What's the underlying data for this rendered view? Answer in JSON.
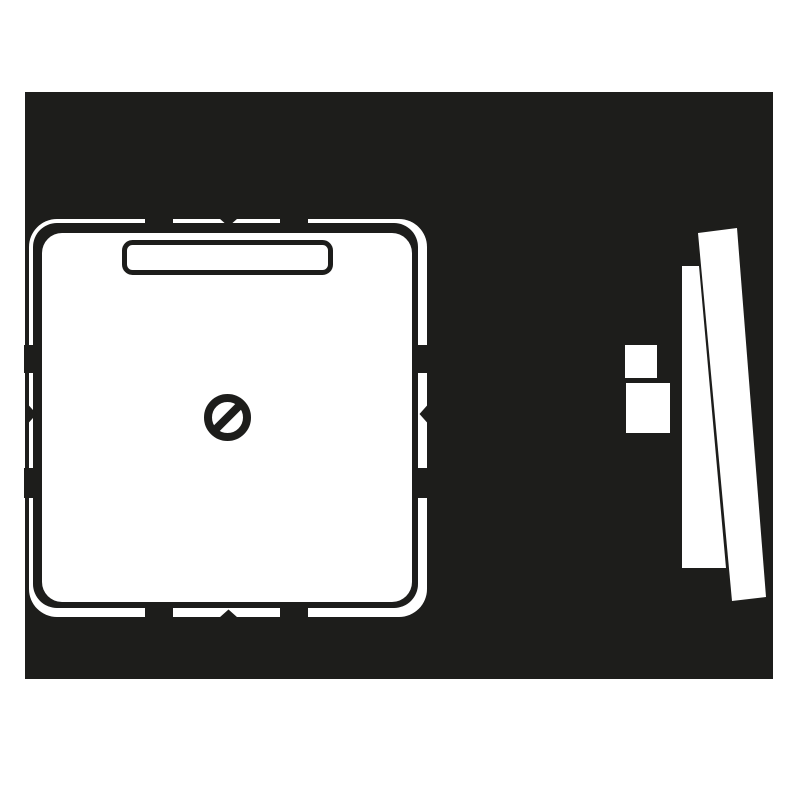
{
  "image": {
    "kind": "technical-product-drawing",
    "subject": "blank-cover-centre-plate",
    "text_content": "none"
  },
  "colors": {
    "page_bg": "#ffffff",
    "panel_bg": "#1d1d1b",
    "artwork_white": "#ffffff",
    "line_ink": "#1d1d1b"
  },
  "views": {
    "front_view": {
      "name": "front-view",
      "parts": [
        "outer-edge-contour",
        "cover-plate-face",
        "label-field-window",
        "centre-screw",
        "mounting-notches"
      ]
    },
    "side_view": {
      "name": "side-view",
      "parts": [
        "claw-block-small",
        "claw-block-large",
        "frame-profile",
        "plate-profile"
      ]
    }
  }
}
